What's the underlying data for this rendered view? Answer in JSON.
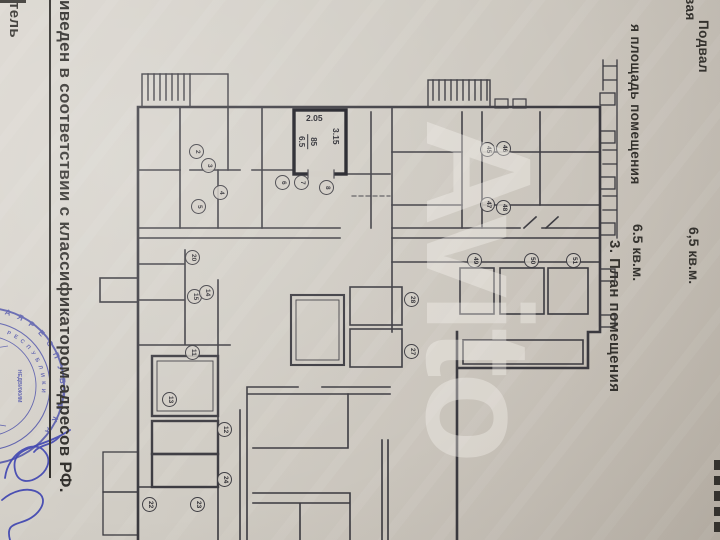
{
  "header": {
    "room_name_fragment": "вая",
    "floor_value": "Подвал",
    "floor_area_value": "6,5 кв.м.",
    "area_label_fragment": "я площадь помещения",
    "area_value": "6.5 кв.м.",
    "section_title": "3. План помещения"
  },
  "left_margin": {
    "compiler_fragment": "тель",
    "disclaimer_fragment": "иведен в соответствии с классификатором адресов РФ."
  },
  "stamp": {
    "outer_arc_text": "А Я   Р Е С П У Б Л И К А",
    "inner_arc_text": "Р Е С П У Б Л И К И",
    "inner_text": "НЕДВИЖИМ"
  },
  "plan": {
    "highlighted_room": {
      "number": "85",
      "area": "6.5",
      "dim_top": "2.05",
      "dim_side": "3.15"
    },
    "room_markers": [
      {
        "n": "2",
        "x": 197,
        "y": 152
      },
      {
        "n": "3",
        "x": 209,
        "y": 166
      },
      {
        "n": "4",
        "x": 221,
        "y": 193
      },
      {
        "n": "5",
        "x": 199,
        "y": 207
      },
      {
        "n": "6",
        "x": 283,
        "y": 183
      },
      {
        "n": "7",
        "x": 302,
        "y": 183
      },
      {
        "n": "8",
        "x": 327,
        "y": 188
      },
      {
        "n": "45",
        "x": 488,
        "y": 150
      },
      {
        "n": "46",
        "x": 504,
        "y": 149
      },
      {
        "n": "47",
        "x": 488,
        "y": 205
      },
      {
        "n": "48",
        "x": 504,
        "y": 208
      },
      {
        "n": "49",
        "x": 475,
        "y": 261
      },
      {
        "n": "50",
        "x": 532,
        "y": 261
      },
      {
        "n": "51",
        "x": 574,
        "y": 261
      },
      {
        "n": "20",
        "x": 193,
        "y": 258
      },
      {
        "n": "15",
        "x": 195,
        "y": 297
      },
      {
        "n": "14",
        "x": 207,
        "y": 293
      },
      {
        "n": "11",
        "x": 193,
        "y": 353
      },
      {
        "n": "13",
        "x": 170,
        "y": 400
      },
      {
        "n": "12",
        "x": 225,
        "y": 430
      },
      {
        "n": "24",
        "x": 225,
        "y": 480
      },
      {
        "n": "22",
        "x": 150,
        "y": 505
      },
      {
        "n": "23",
        "x": 198,
        "y": 505
      },
      {
        "n": "28",
        "x": 412,
        "y": 300
      },
      {
        "n": "27",
        "x": 412,
        "y": 352
      }
    ]
  },
  "watermark": {
    "text": "Avito"
  },
  "colors": {
    "paper": "#cfcac2",
    "ink": "#3a393f",
    "highlight_ink": "#191920",
    "stamp_blue": "#4045a5"
  }
}
